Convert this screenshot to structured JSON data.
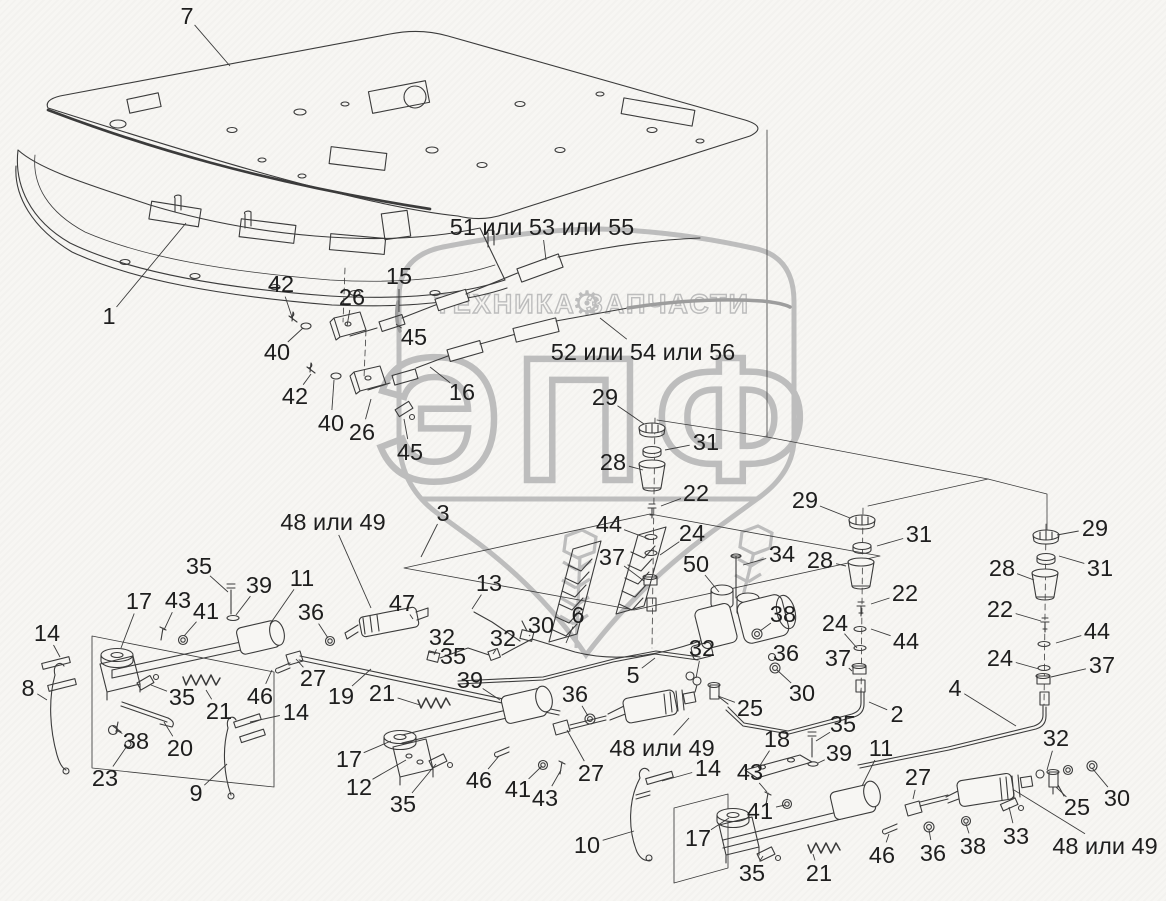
{
  "watermark": {
    "shield_text": "ЭПФ",
    "banner_left": "ТЕХНИКА",
    "banner_right": "ЗАПЧАСТИ",
    "gear_icon": "⚙",
    "color": "#bdbdbd"
  },
  "colors": {
    "line": "#3b3b3b",
    "label": "#1e1e1e",
    "background": "#f7f6f3"
  },
  "callouts": [
    {
      "t": "7",
      "x": 187,
      "y": 16,
      "lx": 230,
      "ly": 66
    },
    {
      "t": "1",
      "x": 109,
      "y": 316,
      "lx": 186,
      "ly": 223
    },
    {
      "t": "15",
      "x": 399,
      "y": 276,
      "lx": 399,
      "ly": 312
    },
    {
      "t": "51 или 53 или 55",
      "x": 542,
      "y": 227,
      "lx": 546,
      "ly": 260
    },
    {
      "t": "52 или 54 или 56",
      "x": 643,
      "y": 352,
      "lx": 600,
      "ly": 318
    },
    {
      "t": "42",
      "x": 281,
      "y": 284,
      "lx": 293,
      "ly": 320
    },
    {
      "t": "26",
      "x": 352,
      "y": 297,
      "lx": 347,
      "ly": 326
    },
    {
      "t": "40",
      "x": 277,
      "y": 352,
      "lx": 303,
      "ly": 328
    },
    {
      "t": "45",
      "x": 414,
      "y": 337,
      "lx": 396,
      "ly": 324
    },
    {
      "t": "42",
      "x": 295,
      "y": 396,
      "lx": 311,
      "ly": 374
    },
    {
      "t": "40",
      "x": 331,
      "y": 423,
      "lx": 334,
      "ly": 380
    },
    {
      "t": "26",
      "x": 362,
      "y": 432,
      "lx": 371,
      "ly": 399
    },
    {
      "t": "16",
      "x": 462,
      "y": 392,
      "lx": 430,
      "ly": 367
    },
    {
      "t": "45",
      "x": 410,
      "y": 452,
      "lx": 404,
      "ly": 419
    },
    {
      "t": "29",
      "x": 605,
      "y": 397,
      "lx": 644,
      "ly": 424
    },
    {
      "t": "31",
      "x": 706,
      "y": 442,
      "lx": 665,
      "ly": 450
    },
    {
      "t": "28",
      "x": 613,
      "y": 462,
      "lx": 643,
      "ly": 470
    },
    {
      "t": "22",
      "x": 696,
      "y": 493,
      "lx": 661,
      "ly": 506
    },
    {
      "t": "44",
      "x": 609,
      "y": 524,
      "lx": 649,
      "ly": 539
    },
    {
      "t": "24",
      "x": 692,
      "y": 533,
      "lx": 660,
      "ly": 555
    },
    {
      "t": "37",
      "x": 612,
      "y": 557,
      "lx": 644,
      "ly": 581
    },
    {
      "t": "50",
      "x": 696,
      "y": 564,
      "lx": 719,
      "ly": 592
    },
    {
      "t": "34",
      "x": 782,
      "y": 554,
      "lx": 743,
      "ly": 565
    },
    {
      "t": "6",
      "x": 578,
      "y": 615,
      "lx": 566,
      "ly": 643
    },
    {
      "t": "13",
      "x": 489,
      "y": 583,
      "lx": 472,
      "ly": 609
    },
    {
      "t": "47",
      "x": 402,
      "y": 603,
      "lx": 413,
      "ly": 619
    },
    {
      "t": "32",
      "x": 442,
      "y": 637,
      "lx": 434,
      "ly": 655
    },
    {
      "t": "32",
      "x": 503,
      "y": 638,
      "lx": 493,
      "ly": 654
    },
    {
      "t": "30",
      "x": 541,
      "y": 625,
      "lx": 529,
      "ly": 636
    },
    {
      "t": "35",
      "x": 453,
      "y": 656,
      "lx": 428,
      "ly": 652
    },
    {
      "t": "39",
      "x": 470,
      "y": 680,
      "lx": 500,
      "ly": 700
    },
    {
      "t": "5",
      "x": 633,
      "y": 675,
      "lx": 655,
      "ly": 658
    },
    {
      "t": "32",
      "x": 702,
      "y": 648,
      "lx": 696,
      "ly": 678
    },
    {
      "t": "36",
      "x": 786,
      "y": 653,
      "lx": 772,
      "ly": 658
    },
    {
      "t": "38",
      "x": 783,
      "y": 614,
      "lx": 760,
      "ly": 631
    },
    {
      "t": "36",
      "x": 575,
      "y": 694,
      "lx": 588,
      "ly": 716
    },
    {
      "t": "25",
      "x": 750,
      "y": 708,
      "lx": 718,
      "ly": 696
    },
    {
      "t": "30",
      "x": 802,
      "y": 693,
      "lx": 777,
      "ly": 670
    },
    {
      "t": "2",
      "x": 897,
      "y": 714,
      "lx": 869,
      "ly": 702
    },
    {
      "t": "4",
      "x": 955,
      "y": 688,
      "lx": 1016,
      "ly": 726
    },
    {
      "t": "48 или 49",
      "x": 662,
      "y": 748,
      "lx": 689,
      "ly": 718
    },
    {
      "t": "27",
      "x": 591,
      "y": 773,
      "lx": 567,
      "ly": 730
    },
    {
      "t": "46",
      "x": 479,
      "y": 780,
      "lx": 499,
      "ly": 756
    },
    {
      "t": "41",
      "x": 518,
      "y": 789,
      "lx": 542,
      "ly": 766
    },
    {
      "t": "43",
      "x": 545,
      "y": 798,
      "lx": 561,
      "ly": 770
    },
    {
      "t": "35",
      "x": 403,
      "y": 804,
      "lx": 436,
      "ly": 764
    },
    {
      "t": "14",
      "x": 296,
      "y": 712,
      "lx": 250,
      "ly": 722
    },
    {
      "t": "21",
      "x": 382,
      "y": 693,
      "lx": 420,
      "ly": 705
    },
    {
      "t": "19",
      "x": 341,
      "y": 696,
      "lx": 371,
      "ly": 669
    },
    {
      "t": "27",
      "x": 313,
      "y": 678,
      "lx": 296,
      "ly": 659
    },
    {
      "t": "46",
      "x": 260,
      "y": 696,
      "lx": 272,
      "ly": 670
    },
    {
      "t": "21",
      "x": 219,
      "y": 711,
      "lx": 206,
      "ly": 690
    },
    {
      "t": "35",
      "x": 182,
      "y": 697,
      "lx": 151,
      "ly": 685
    },
    {
      "t": "17",
      "x": 139,
      "y": 601,
      "lx": 121,
      "ly": 648
    },
    {
      "t": "43",
      "x": 178,
      "y": 600,
      "lx": 164,
      "ly": 630
    },
    {
      "t": "41",
      "x": 206,
      "y": 611,
      "lx": 184,
      "ly": 636
    },
    {
      "t": "35",
      "x": 199,
      "y": 566,
      "lx": 228,
      "ly": 592
    },
    {
      "t": "39",
      "x": 259,
      "y": 585,
      "lx": 236,
      "ly": 615
    },
    {
      "t": "11",
      "x": 302,
      "y": 578,
      "lx": 270,
      "ly": 624
    },
    {
      "t": "36",
      "x": 311,
      "y": 612,
      "lx": 328,
      "ly": 638
    },
    {
      "t": "14",
      "x": 47,
      "y": 633,
      "lx": 60,
      "ly": 657
    },
    {
      "t": "8",
      "x": 28,
      "y": 688,
      "lx": 47,
      "ly": 700
    },
    {
      "t": "38",
      "x": 136,
      "y": 741,
      "lx": 116,
      "ly": 730
    },
    {
      "t": "20",
      "x": 180,
      "y": 748,
      "lx": 164,
      "ly": 722
    },
    {
      "t": "23",
      "x": 105,
      "y": 778,
      "lx": 127,
      "ly": 746
    },
    {
      "t": "9",
      "x": 196,
      "y": 793,
      "lx": 227,
      "ly": 764
    },
    {
      "t": "17",
      "x": 349,
      "y": 759,
      "lx": 391,
      "ly": 741
    },
    {
      "t": "12",
      "x": 359,
      "y": 787,
      "lx": 406,
      "ly": 760
    },
    {
      "t": "10",
      "x": 587,
      "y": 845,
      "lx": 634,
      "ly": 831
    },
    {
      "t": "17",
      "x": 698,
      "y": 838,
      "lx": 729,
      "ly": 818
    },
    {
      "t": "14",
      "x": 708,
      "y": 768,
      "lx": 662,
      "ly": 781
    },
    {
      "t": "43",
      "x": 750,
      "y": 772,
      "lx": 767,
      "ly": 792
    },
    {
      "t": "18",
      "x": 777,
      "y": 739,
      "lx": 759,
      "ly": 767
    },
    {
      "t": "35",
      "x": 843,
      "y": 724,
      "lx": 816,
      "ly": 741
    },
    {
      "t": "39",
      "x": 839,
      "y": 753,
      "lx": 818,
      "ly": 763
    },
    {
      "t": "11",
      "x": 881,
      "y": 748,
      "lx": 862,
      "ly": 786
    },
    {
      "t": "27",
      "x": 918,
      "y": 777,
      "lx": 913,
      "ly": 799
    },
    {
      "t": "41",
      "x": 760,
      "y": 811,
      "lx": 785,
      "ly": 805
    },
    {
      "t": "35",
      "x": 752,
      "y": 873,
      "lx": 763,
      "ly": 856
    },
    {
      "t": "21",
      "x": 819,
      "y": 873,
      "lx": 813,
      "ly": 854
    },
    {
      "t": "46",
      "x": 882,
      "y": 855,
      "lx": 889,
      "ly": 834
    },
    {
      "t": "36",
      "x": 933,
      "y": 853,
      "lx": 929,
      "ly": 830
    },
    {
      "t": "38",
      "x": 973,
      "y": 846,
      "lx": 966,
      "ly": 824
    },
    {
      "t": "33",
      "x": 1016,
      "y": 836,
      "lx": 1009,
      "ly": 807
    },
    {
      "t": "48 или 49",
      "x": 1105,
      "y": 846,
      "lx": 1014,
      "ly": 790
    },
    {
      "t": "32",
      "x": 1056,
      "y": 738,
      "lx": 1047,
      "ly": 770
    },
    {
      "t": "25",
      "x": 1077,
      "y": 807,
      "lx": 1056,
      "ly": 787
    },
    {
      "t": "30",
      "x": 1117,
      "y": 798,
      "lx": 1092,
      "ly": 768
    },
    {
      "t": "29",
      "x": 805,
      "y": 500,
      "lx": 850,
      "ly": 518
    },
    {
      "t": "31",
      "x": 919,
      "y": 534,
      "lx": 877,
      "ly": 546
    },
    {
      "t": "28",
      "x": 820,
      "y": 560,
      "lx": 846,
      "ly": 566
    },
    {
      "t": "22",
      "x": 905,
      "y": 593,
      "lx": 871,
      "ly": 604
    },
    {
      "t": "24",
      "x": 835,
      "y": 623,
      "lx": 857,
      "ly": 648
    },
    {
      "t": "44",
      "x": 906,
      "y": 641,
      "lx": 871,
      "ly": 629
    },
    {
      "t": "37",
      "x": 838,
      "y": 658,
      "lx": 852,
      "ly": 671
    },
    {
      "t": "29",
      "x": 1095,
      "y": 528,
      "lx": 1057,
      "ly": 535
    },
    {
      "t": "31",
      "x": 1100,
      "y": 568,
      "lx": 1059,
      "ly": 556
    },
    {
      "t": "28",
      "x": 1002,
      "y": 568,
      "lx": 1034,
      "ly": 580
    },
    {
      "t": "22",
      "x": 1000,
      "y": 609,
      "lx": 1041,
      "ly": 621
    },
    {
      "t": "44",
      "x": 1097,
      "y": 631,
      "lx": 1056,
      "ly": 643
    },
    {
      "t": "24",
      "x": 1000,
      "y": 658,
      "lx": 1039,
      "ly": 669
    },
    {
      "t": "37",
      "x": 1102,
      "y": 665,
      "lx": 1051,
      "ly": 677
    },
    {
      "t": "3",
      "x": 443,
      "y": 513,
      "lx": 421,
      "ly": 557
    },
    {
      "t": "48 или 49",
      "x": 333,
      "y": 522,
      "lx": 371,
      "ly": 608
    }
  ]
}
